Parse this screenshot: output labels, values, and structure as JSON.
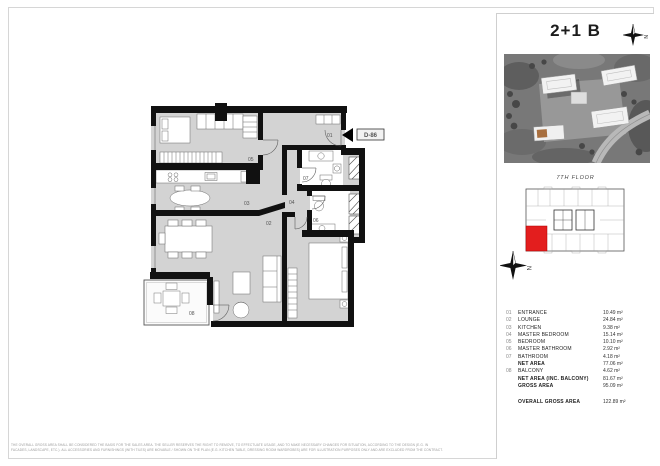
{
  "panel": {
    "unit_type": "2+1 B",
    "floor_label": "7TH FLOOR",
    "compass_letter": "N"
  },
  "plan": {
    "unit_code": "D-86"
  },
  "areas": {
    "rows": [
      {
        "num": "01",
        "label": "ENTRANCE",
        "value": "10.49 m²"
      },
      {
        "num": "02",
        "label": "LOUNGE",
        "value": "24.84 m²"
      },
      {
        "num": "03",
        "label": "KITCHEN",
        "value": "9.38 m²"
      },
      {
        "num": "04",
        "label": "MASTER BEDROOM",
        "value": "15.14 m²"
      },
      {
        "num": "05",
        "label": "BEDROOM",
        "value": "10.10 m²"
      },
      {
        "num": "06",
        "label": "MASTER BATHROOM",
        "value": "2.92 m²"
      },
      {
        "num": "07",
        "label": "BATHROOM",
        "value": "4.18 m²"
      },
      {
        "num": "",
        "label": "NET AREA",
        "value": "77.06 m²"
      },
      {
        "num": "08",
        "label": "BALCONY",
        "value": "4.62 m²"
      },
      {
        "num": "",
        "label": "NET AREA (INC. BALCONY)",
        "value": "81.67 m²"
      },
      {
        "num": "",
        "label": "GROSS AREA",
        "value": "95.09 m²"
      },
      {
        "num": "",
        "label": "OVERALL GROSS AREA",
        "value": "122.89 m²"
      }
    ]
  },
  "disclaimer": {
    "line1": "THE OVERALL GROSS AREA SHALL BE CONSIDERED THE BASIS FOR THE SALES AREA. THE SELLER RESERVES THE RIGHT TO REMOVE, TO EFFECTUATE USAGE, AND TO MAKE NECESSARY CHANGES FOR SITUATION, ACCORDING TO THE DESIGN (E.G. IN",
    "line2": "FACADES, LANDSCAPE, ETC.). ALL ACCESSORIES AND FURNISHINGS (WITH TILES) ARE MOVABLE / SHOWN ON THE PLAN (E.G. KITCHEN TABLE, DRESSING ROOM WARDROBES) ARE FOR ILLUSTRATION PURPOSES ONLY AND ARE EXCLUDED FROM THE CONTRACT."
  }
}
